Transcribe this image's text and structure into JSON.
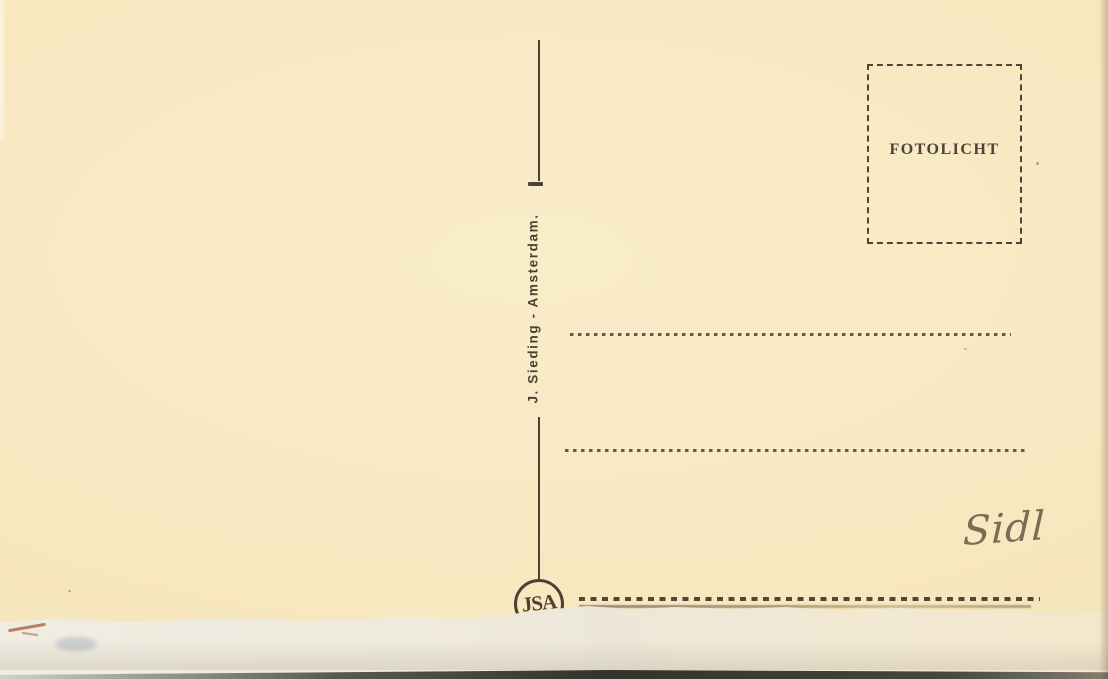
{
  "postcard": {
    "publisher_credit": "J. Sieding - Amsterdam.",
    "stamp_box": {
      "label": "FOTOLICHT"
    },
    "logo": {
      "monogram": "JSA"
    },
    "handwriting": {
      "text": "Sidl"
    },
    "address_lines_count": 3,
    "colors": {
      "paper": "#f8e8c0",
      "ink": "#4a4335",
      "handwriting_ink": "#6d5f4a",
      "torn_paper": "#efeadd",
      "red_mark": "#b26a4e"
    }
  }
}
